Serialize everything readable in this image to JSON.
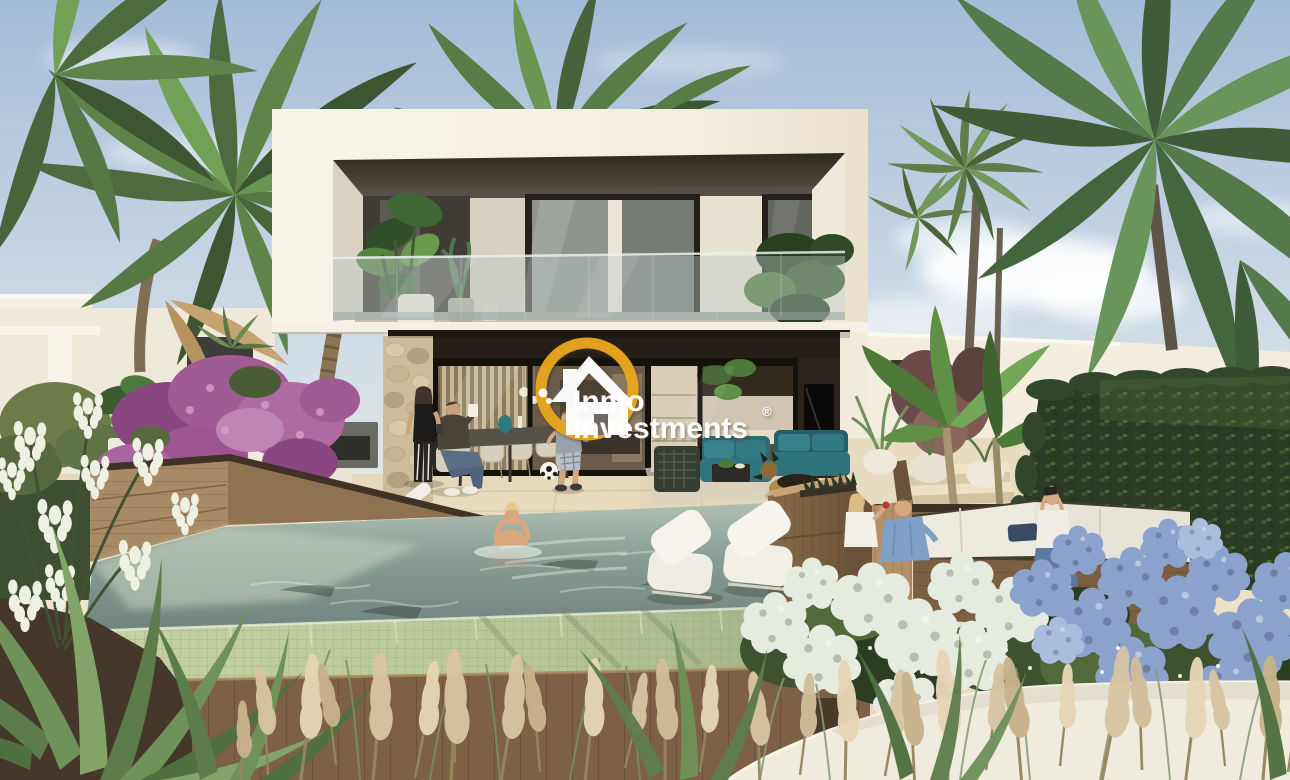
{
  "image": {
    "kind": "3D architectural render (photorealistic promotional image)",
    "subject": "Modern two-storey white villa with cantilevered balcony, glass terrace, infinity pool, sunken lounge, palms and flower garden at golden hour",
    "people_visible": 8,
    "dog_visible": 1
  },
  "watermark": {
    "line1": "Inmo",
    "line2": "Investments",
    "registered": "®",
    "ring_color": "#EAA61E",
    "text_color": "#FFFFFF",
    "house_color": "#FFFFFF"
  },
  "palette": {
    "sky_top": "#A3BCD8",
    "sky_mid": "#C9D7E5",
    "sky_horizon": "#E6E9E5",
    "villa_white": "#F6F1E4",
    "villa_shade": "#E3DAC6",
    "soffit_dark": "#3C362C",
    "terrace": "#EADDC2",
    "pool_water_deep": "#6F847F",
    "pool_water_light": "#AFBFB4",
    "pool_mosaic": "#C6D1A4",
    "wood_wall": "#8A6C4B",
    "wood_structure": "#A98760",
    "hedge_green": "#2C3B23",
    "sofa_teal": "#2A6B74",
    "hydrangea_blue": "#8AA2CC",
    "hydrangea_white": "#E6EBDF",
    "pampas": "#D8C4A3",
    "bougainvillea": "#A55B97"
  },
  "scene": {
    "areas": [
      "sky",
      "clouds",
      "palm-trees",
      "neighbour-houses",
      "villa-upper-balcony",
      "balcony-glass-railing",
      "villa-lower-terrace",
      "outdoor-dining-set",
      "teal-lounge-set",
      "german-shepherd-dog",
      "infinity-pool",
      "in-pool-loungers",
      "sun-loungers",
      "sunken-lounge",
      "hydrangea-bed",
      "hedge-wall",
      "pampas-grass",
      "yucca-and-agave",
      "bougainvillea"
    ]
  }
}
